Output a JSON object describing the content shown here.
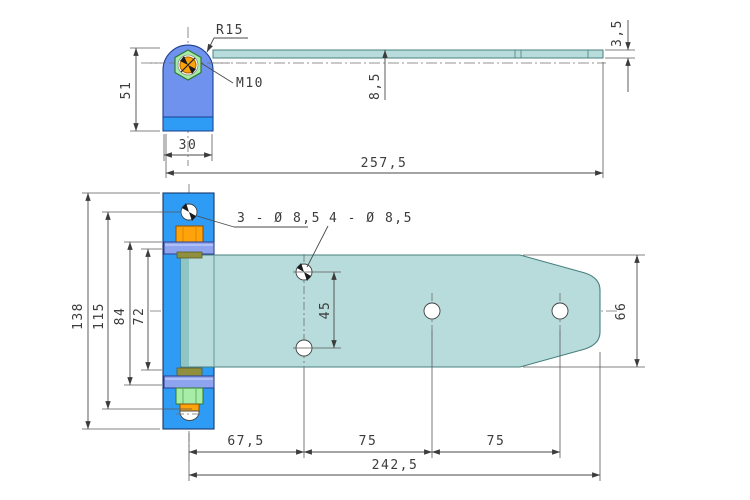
{
  "title": "Hinge technical drawing, two orthographic views",
  "colors": {
    "bracket_body": "#6f92ee",
    "bracket_base": "#2e9bf5",
    "plate_blue": "#2e9bf5",
    "strap_teal": "#b7dcdb",
    "strap_edge": "#47807e",
    "strap_dark_strip": "#8fc6c4",
    "knuckle_band": "#8ea4ee",
    "nut_orange": "#ffa30a",
    "nut_green": "#a7eca7",
    "washer_olive": "#8f8f3e",
    "line": "#4a4a4a"
  },
  "top_view": {
    "labels": {
      "radius": "R15",
      "thread": "M10"
    },
    "dims": {
      "bracket_height": "51",
      "bracket_width": "30",
      "strap_offset": "8,5",
      "strap_thickness": "3,5",
      "total_length": "257,5"
    }
  },
  "bottom_view": {
    "labels": {
      "plate_holes": "3 - Ø 8,5",
      "strap_holes": "4 - Ø 8,5"
    },
    "dims": {
      "plate_height": "138",
      "plate_hole_span": "115",
      "knuckle_outer": "84",
      "knuckle_inner": "72",
      "hole_pair": "45",
      "strap_width": "66",
      "seg1": "67,5",
      "seg2": "75",
      "seg3": "75",
      "total": "242,5"
    }
  }
}
